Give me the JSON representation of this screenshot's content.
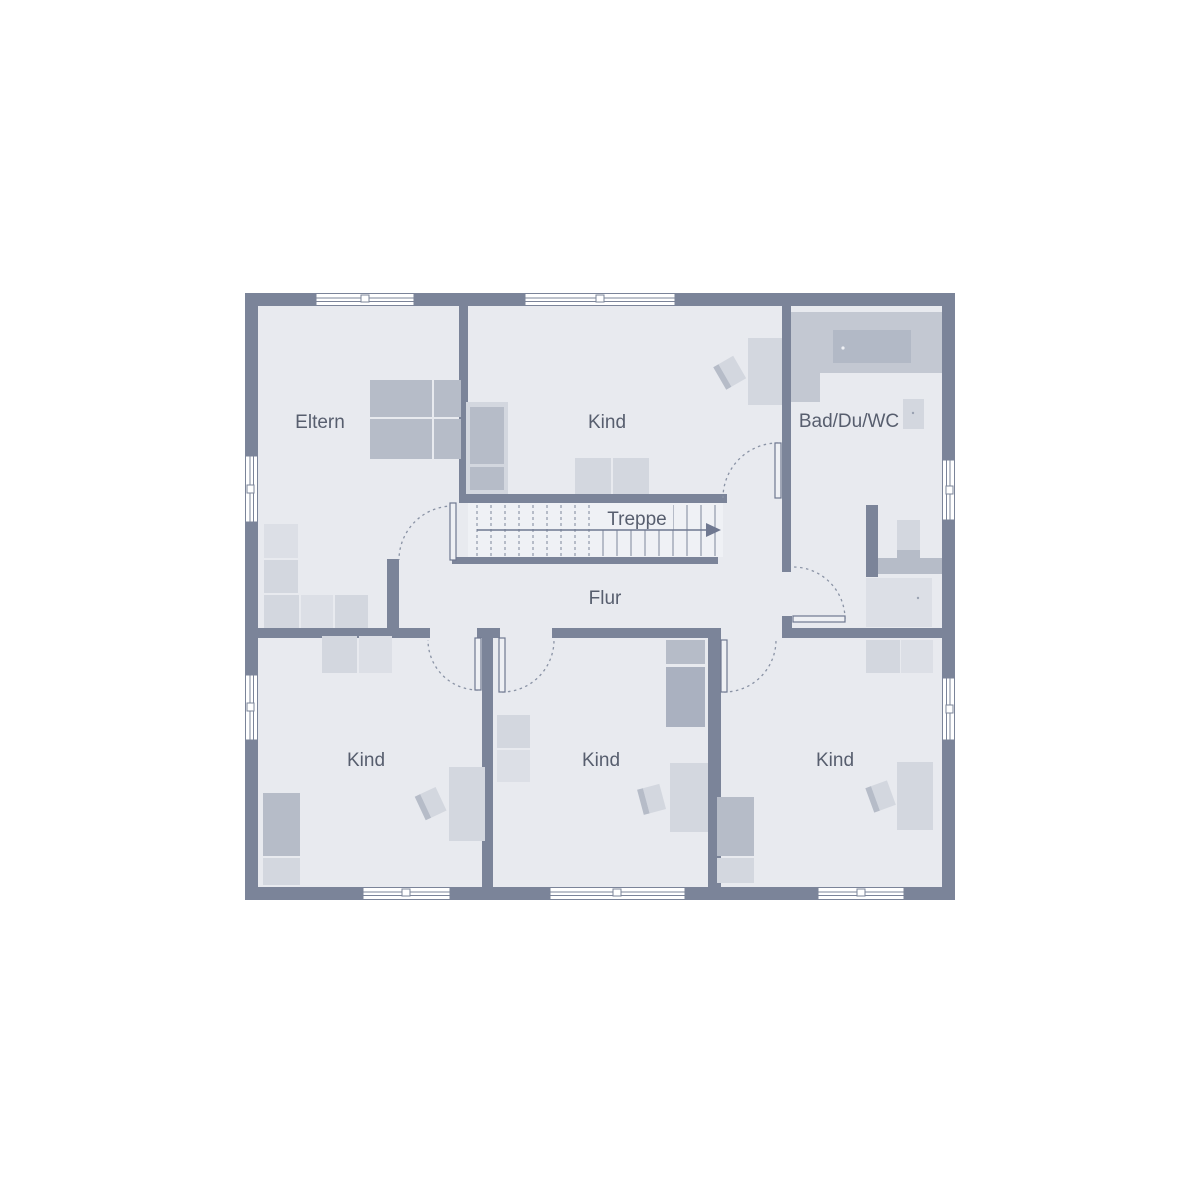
{
  "rooms": [
    {
      "id": "eltern",
      "label": "Eltern"
    },
    {
      "id": "kind-top",
      "label": "Kind"
    },
    {
      "id": "bad-du-wc",
      "label": "Bad/Du/WC"
    },
    {
      "id": "treppe",
      "label": "Treppe"
    },
    {
      "id": "flur",
      "label": "Flur"
    },
    {
      "id": "kind-bottom-left",
      "label": "Kind"
    },
    {
      "id": "kind-bottom-middle",
      "label": "Kind"
    },
    {
      "id": "kind-bottom-right",
      "label": "Kind"
    }
  ],
  "colors": {
    "background": "#ffffff",
    "wall": "#7b8499",
    "floor": "#e8eaef",
    "stair_floor": "#eff1f5",
    "furniture_light": "#d3d7df",
    "furniture_medium": "#b6bcc8",
    "furniture_dark": "#aab1c0",
    "bath_tile": "#c3c8d2",
    "label_text": "#575e6e",
    "detail_line": "#8a93a5"
  }
}
